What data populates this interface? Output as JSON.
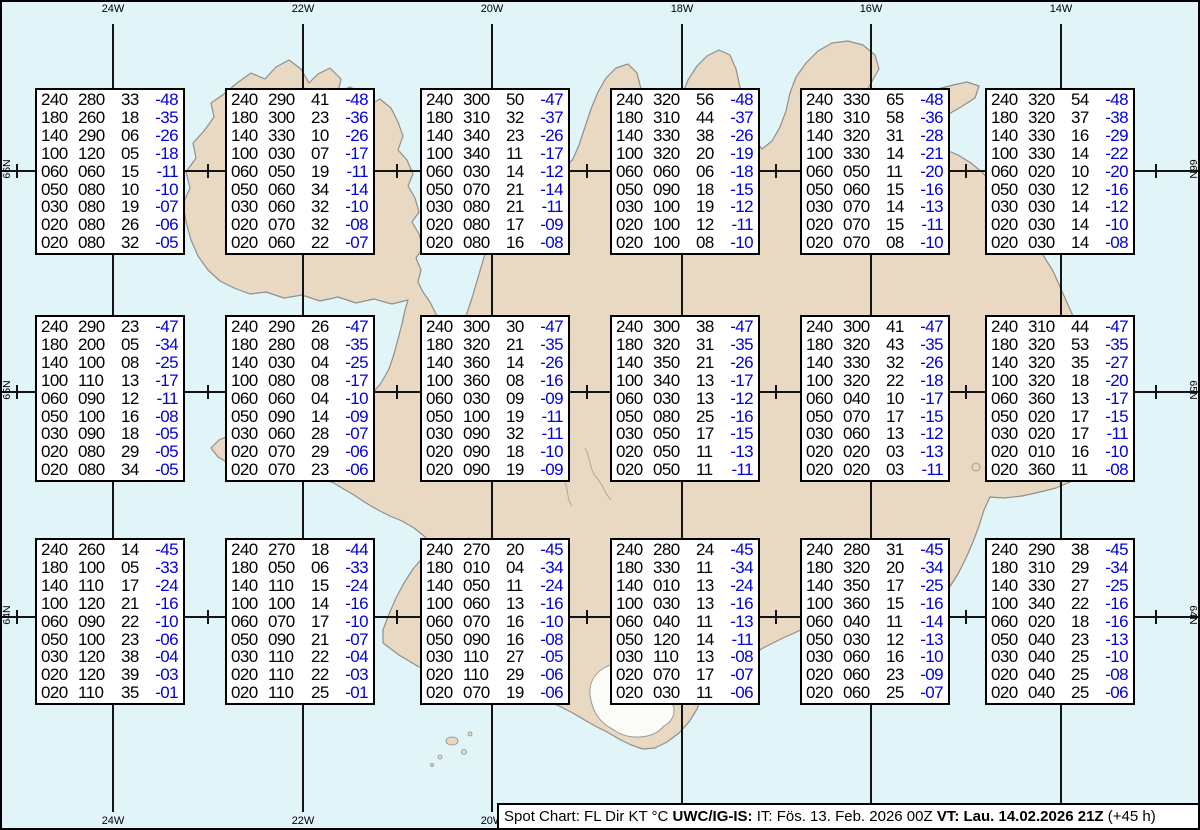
{
  "status_bar": {
    "segments": [
      {
        "text": "Spot Chart: FL Dir KT °C ",
        "bold": false
      },
      {
        "text": "UWC/IG-IS:",
        "bold": true
      },
      {
        "text": " IT: Fös. 13. Feb. 2026 00Z ",
        "bold": false
      },
      {
        "text": "VT: Lau. 14.02.2026 21Z",
        "bold": true
      },
      {
        "text": " (+45 h)",
        "bold": false
      }
    ]
  },
  "grid": {
    "top_longitude_labels": [
      "24W",
      "22W",
      "20W",
      "18W",
      "16W",
      "14W"
    ],
    "bottom_longitude_labels": [
      "24W",
      "22W",
      "20W"
    ],
    "left_latitude_labels": [
      "66N",
      "65N",
      "64N"
    ],
    "right_latitude_labels": [
      "66N",
      "65N",
      "64N"
    ]
  },
  "colors": {
    "ocean": "#e1f4f8",
    "land": "#e9d9c2",
    "coast": "#8f8f8d",
    "grid": "#141414",
    "temp_blue": "#0000dd",
    "box_background": "#ffffff",
    "box_border": "#000000"
  },
  "chart_data": {
    "type": "table",
    "columns": [
      "FL",
      "Dir",
      "KT",
      "TempC"
    ],
    "flight_levels": [
      "240",
      "180",
      "140",
      "100",
      "060",
      "050",
      "030",
      "020",
      "020"
    ],
    "boxes": [
      {
        "rows": [
          [
            "240",
            "280",
            "33",
            "-48"
          ],
          [
            "180",
            "260",
            "18",
            "-35"
          ],
          [
            "140",
            "290",
            "06",
            "-26"
          ],
          [
            "100",
            "120",
            "05",
            "-18"
          ],
          [
            "060",
            "060",
            "15",
            "-11"
          ],
          [
            "050",
            "080",
            "10",
            "-10"
          ],
          [
            "030",
            "080",
            "19",
            "-07"
          ],
          [
            "020",
            "080",
            "26",
            "-06"
          ],
          [
            "020",
            "080",
            "32",
            "-05"
          ]
        ]
      },
      {
        "rows": [
          [
            "240",
            "290",
            "41",
            "-48"
          ],
          [
            "180",
            "300",
            "23",
            "-36"
          ],
          [
            "140",
            "330",
            "10",
            "-26"
          ],
          [
            "100",
            "030",
            "07",
            "-17"
          ],
          [
            "060",
            "050",
            "19",
            "-11"
          ],
          [
            "050",
            "060",
            "34",
            "-14"
          ],
          [
            "030",
            "060",
            "32",
            "-10"
          ],
          [
            "020",
            "070",
            "32",
            "-08"
          ],
          [
            "020",
            "060",
            "22",
            "-07"
          ]
        ]
      },
      {
        "rows": [
          [
            "240",
            "300",
            "50",
            "-47"
          ],
          [
            "180",
            "310",
            "32",
            "-37"
          ],
          [
            "140",
            "340",
            "23",
            "-26"
          ],
          [
            "100",
            "340",
            "11",
            "-17"
          ],
          [
            "060",
            "030",
            "14",
            "-12"
          ],
          [
            "050",
            "070",
            "21",
            "-14"
          ],
          [
            "030",
            "080",
            "21",
            "-11"
          ],
          [
            "020",
            "080",
            "17",
            "-09"
          ],
          [
            "020",
            "080",
            "16",
            "-08"
          ]
        ]
      },
      {
        "rows": [
          [
            "240",
            "320",
            "56",
            "-48"
          ],
          [
            "180",
            "310",
            "44",
            "-37"
          ],
          [
            "140",
            "330",
            "38",
            "-26"
          ],
          [
            "100",
            "320",
            "20",
            "-19"
          ],
          [
            "060",
            "060",
            "06",
            "-18"
          ],
          [
            "050",
            "090",
            "18",
            "-15"
          ],
          [
            "030",
            "100",
            "19",
            "-12"
          ],
          [
            "020",
            "100",
            "12",
            "-11"
          ],
          [
            "020",
            "100",
            "08",
            "-10"
          ]
        ]
      },
      {
        "rows": [
          [
            "240",
            "330",
            "65",
            "-48"
          ],
          [
            "180",
            "310",
            "58",
            "-36"
          ],
          [
            "140",
            "320",
            "31",
            "-28"
          ],
          [
            "100",
            "330",
            "14",
            "-21"
          ],
          [
            "060",
            "050",
            "11",
            "-20"
          ],
          [
            "050",
            "060",
            "15",
            "-16"
          ],
          [
            "030",
            "070",
            "14",
            "-13"
          ],
          [
            "020",
            "070",
            "15",
            "-11"
          ],
          [
            "020",
            "070",
            "08",
            "-10"
          ]
        ]
      },
      {
        "rows": [
          [
            "240",
            "320",
            "54",
            "-48"
          ],
          [
            "180",
            "320",
            "37",
            "-38"
          ],
          [
            "140",
            "330",
            "16",
            "-29"
          ],
          [
            "100",
            "330",
            "14",
            "-22"
          ],
          [
            "060",
            "020",
            "10",
            "-20"
          ],
          [
            "050",
            "030",
            "12",
            "-16"
          ],
          [
            "030",
            "030",
            "14",
            "-12"
          ],
          [
            "020",
            "030",
            "14",
            "-10"
          ],
          [
            "020",
            "030",
            "14",
            "-08"
          ]
        ]
      },
      {
        "rows": [
          [
            "240",
            "290",
            "23",
            "-47"
          ],
          [
            "180",
            "200",
            "05",
            "-34"
          ],
          [
            "140",
            "100",
            "08",
            "-25"
          ],
          [
            "100",
            "110",
            "13",
            "-17"
          ],
          [
            "060",
            "090",
            "12",
            "-11"
          ],
          [
            "050",
            "100",
            "16",
            "-08"
          ],
          [
            "030",
            "090",
            "18",
            "-05"
          ],
          [
            "020",
            "080",
            "29",
            "-05"
          ],
          [
            "020",
            "080",
            "34",
            "-05"
          ]
        ]
      },
      {
        "rows": [
          [
            "240",
            "290",
            "26",
            "-47"
          ],
          [
            "180",
            "280",
            "08",
            "-35"
          ],
          [
            "140",
            "030",
            "04",
            "-25"
          ],
          [
            "100",
            "080",
            "08",
            "-17"
          ],
          [
            "060",
            "060",
            "04",
            "-10"
          ],
          [
            "050",
            "090",
            "14",
            "-09"
          ],
          [
            "030",
            "060",
            "28",
            "-07"
          ],
          [
            "020",
            "070",
            "29",
            "-06"
          ],
          [
            "020",
            "070",
            "23",
            "-06"
          ]
        ]
      },
      {
        "rows": [
          [
            "240",
            "300",
            "30",
            "-47"
          ],
          [
            "180",
            "320",
            "21",
            "-35"
          ],
          [
            "140",
            "360",
            "14",
            "-26"
          ],
          [
            "100",
            "360",
            "08",
            "-16"
          ],
          [
            "060",
            "030",
            "09",
            "-09"
          ],
          [
            "050",
            "100",
            "19",
            "-11"
          ],
          [
            "030",
            "090",
            "32",
            "-11"
          ],
          [
            "020",
            "090",
            "18",
            "-10"
          ],
          [
            "020",
            "090",
            "19",
            "-09"
          ]
        ]
      },
      {
        "rows": [
          [
            "240",
            "300",
            "38",
            "-47"
          ],
          [
            "180",
            "320",
            "31",
            "-35"
          ],
          [
            "140",
            "350",
            "21",
            "-26"
          ],
          [
            "100",
            "340",
            "13",
            "-17"
          ],
          [
            "060",
            "030",
            "13",
            "-12"
          ],
          [
            "050",
            "080",
            "25",
            "-16"
          ],
          [
            "030",
            "050",
            "17",
            "-15"
          ],
          [
            "020",
            "050",
            "11",
            "-13"
          ],
          [
            "020",
            "050",
            "11",
            "-11"
          ]
        ]
      },
      {
        "rows": [
          [
            "240",
            "300",
            "41",
            "-47"
          ],
          [
            "180",
            "320",
            "43",
            "-35"
          ],
          [
            "140",
            "330",
            "32",
            "-26"
          ],
          [
            "100",
            "320",
            "22",
            "-18"
          ],
          [
            "060",
            "040",
            "10",
            "-17"
          ],
          [
            "050",
            "070",
            "17",
            "-15"
          ],
          [
            "030",
            "060",
            "13",
            "-12"
          ],
          [
            "020",
            "020",
            "03",
            "-13"
          ],
          [
            "020",
            "020",
            "03",
            "-11"
          ]
        ]
      },
      {
        "rows": [
          [
            "240",
            "310",
            "44",
            "-47"
          ],
          [
            "180",
            "320",
            "53",
            "-35"
          ],
          [
            "140",
            "320",
            "35",
            "-27"
          ],
          [
            "100",
            "320",
            "18",
            "-20"
          ],
          [
            "060",
            "360",
            "13",
            "-17"
          ],
          [
            "050",
            "020",
            "17",
            "-15"
          ],
          [
            "030",
            "020",
            "17",
            "-11"
          ],
          [
            "020",
            "010",
            "16",
            "-10"
          ],
          [
            "020",
            "360",
            "11",
            "-08"
          ]
        ]
      },
      {
        "rows": [
          [
            "240",
            "260",
            "14",
            "-45"
          ],
          [
            "180",
            "100",
            "05",
            "-33"
          ],
          [
            "140",
            "110",
            "17",
            "-24"
          ],
          [
            "100",
            "120",
            "21",
            "-16"
          ],
          [
            "060",
            "090",
            "22",
            "-10"
          ],
          [
            "050",
            "100",
            "23",
            "-06"
          ],
          [
            "030",
            "120",
            "38",
            "-04"
          ],
          [
            "020",
            "120",
            "39",
            "-03"
          ],
          [
            "020",
            "110",
            "35",
            "-01"
          ]
        ]
      },
      {
        "rows": [
          [
            "240",
            "270",
            "18",
            "-44"
          ],
          [
            "180",
            "050",
            "06",
            "-33"
          ],
          [
            "140",
            "110",
            "15",
            "-24"
          ],
          [
            "100",
            "100",
            "14",
            "-16"
          ],
          [
            "060",
            "070",
            "17",
            "-10"
          ],
          [
            "050",
            "090",
            "21",
            "-07"
          ],
          [
            "030",
            "110",
            "22",
            "-04"
          ],
          [
            "020",
            "110",
            "22",
            "-03"
          ],
          [
            "020",
            "110",
            "25",
            "-01"
          ]
        ]
      },
      {
        "rows": [
          [
            "240",
            "270",
            "20",
            "-45"
          ],
          [
            "180",
            "010",
            "04",
            "-34"
          ],
          [
            "140",
            "050",
            "11",
            "-24"
          ],
          [
            "100",
            "060",
            "13",
            "-16"
          ],
          [
            "060",
            "070",
            "16",
            "-10"
          ],
          [
            "050",
            "090",
            "16",
            "-08"
          ],
          [
            "030",
            "110",
            "27",
            "-05"
          ],
          [
            "020",
            "110",
            "29",
            "-06"
          ],
          [
            "020",
            "070",
            "19",
            "-06"
          ]
        ]
      },
      {
        "rows": [
          [
            "240",
            "280",
            "24",
            "-45"
          ],
          [
            "180",
            "330",
            "11",
            "-34"
          ],
          [
            "140",
            "010",
            "13",
            "-24"
          ],
          [
            "100",
            "030",
            "13",
            "-16"
          ],
          [
            "060",
            "040",
            "11",
            "-13"
          ],
          [
            "050",
            "120",
            "14",
            "-11"
          ],
          [
            "030",
            "110",
            "13",
            "-08"
          ],
          [
            "020",
            "070",
            "17",
            "-07"
          ],
          [
            "020",
            "030",
            "11",
            "-06"
          ]
        ]
      },
      {
        "rows": [
          [
            "240",
            "280",
            "31",
            "-45"
          ],
          [
            "180",
            "320",
            "20",
            "-34"
          ],
          [
            "140",
            "350",
            "17",
            "-25"
          ],
          [
            "100",
            "360",
            "15",
            "-16"
          ],
          [
            "060",
            "040",
            "11",
            "-14"
          ],
          [
            "050",
            "030",
            "12",
            "-13"
          ],
          [
            "030",
            "060",
            "16",
            "-10"
          ],
          [
            "020",
            "060",
            "23",
            "-09"
          ],
          [
            "020",
            "060",
            "25",
            "-07"
          ]
        ]
      },
      {
        "rows": [
          [
            "240",
            "290",
            "38",
            "-45"
          ],
          [
            "180",
            "310",
            "29",
            "-34"
          ],
          [
            "140",
            "330",
            "27",
            "-25"
          ],
          [
            "100",
            "340",
            "22",
            "-16"
          ],
          [
            "060",
            "020",
            "18",
            "-16"
          ],
          [
            "050",
            "040",
            "23",
            "-13"
          ],
          [
            "030",
            "040",
            "25",
            "-10"
          ],
          [
            "020",
            "040",
            "25",
            "-08"
          ],
          [
            "020",
            "040",
            "25",
            "-06"
          ]
        ]
      }
    ]
  }
}
